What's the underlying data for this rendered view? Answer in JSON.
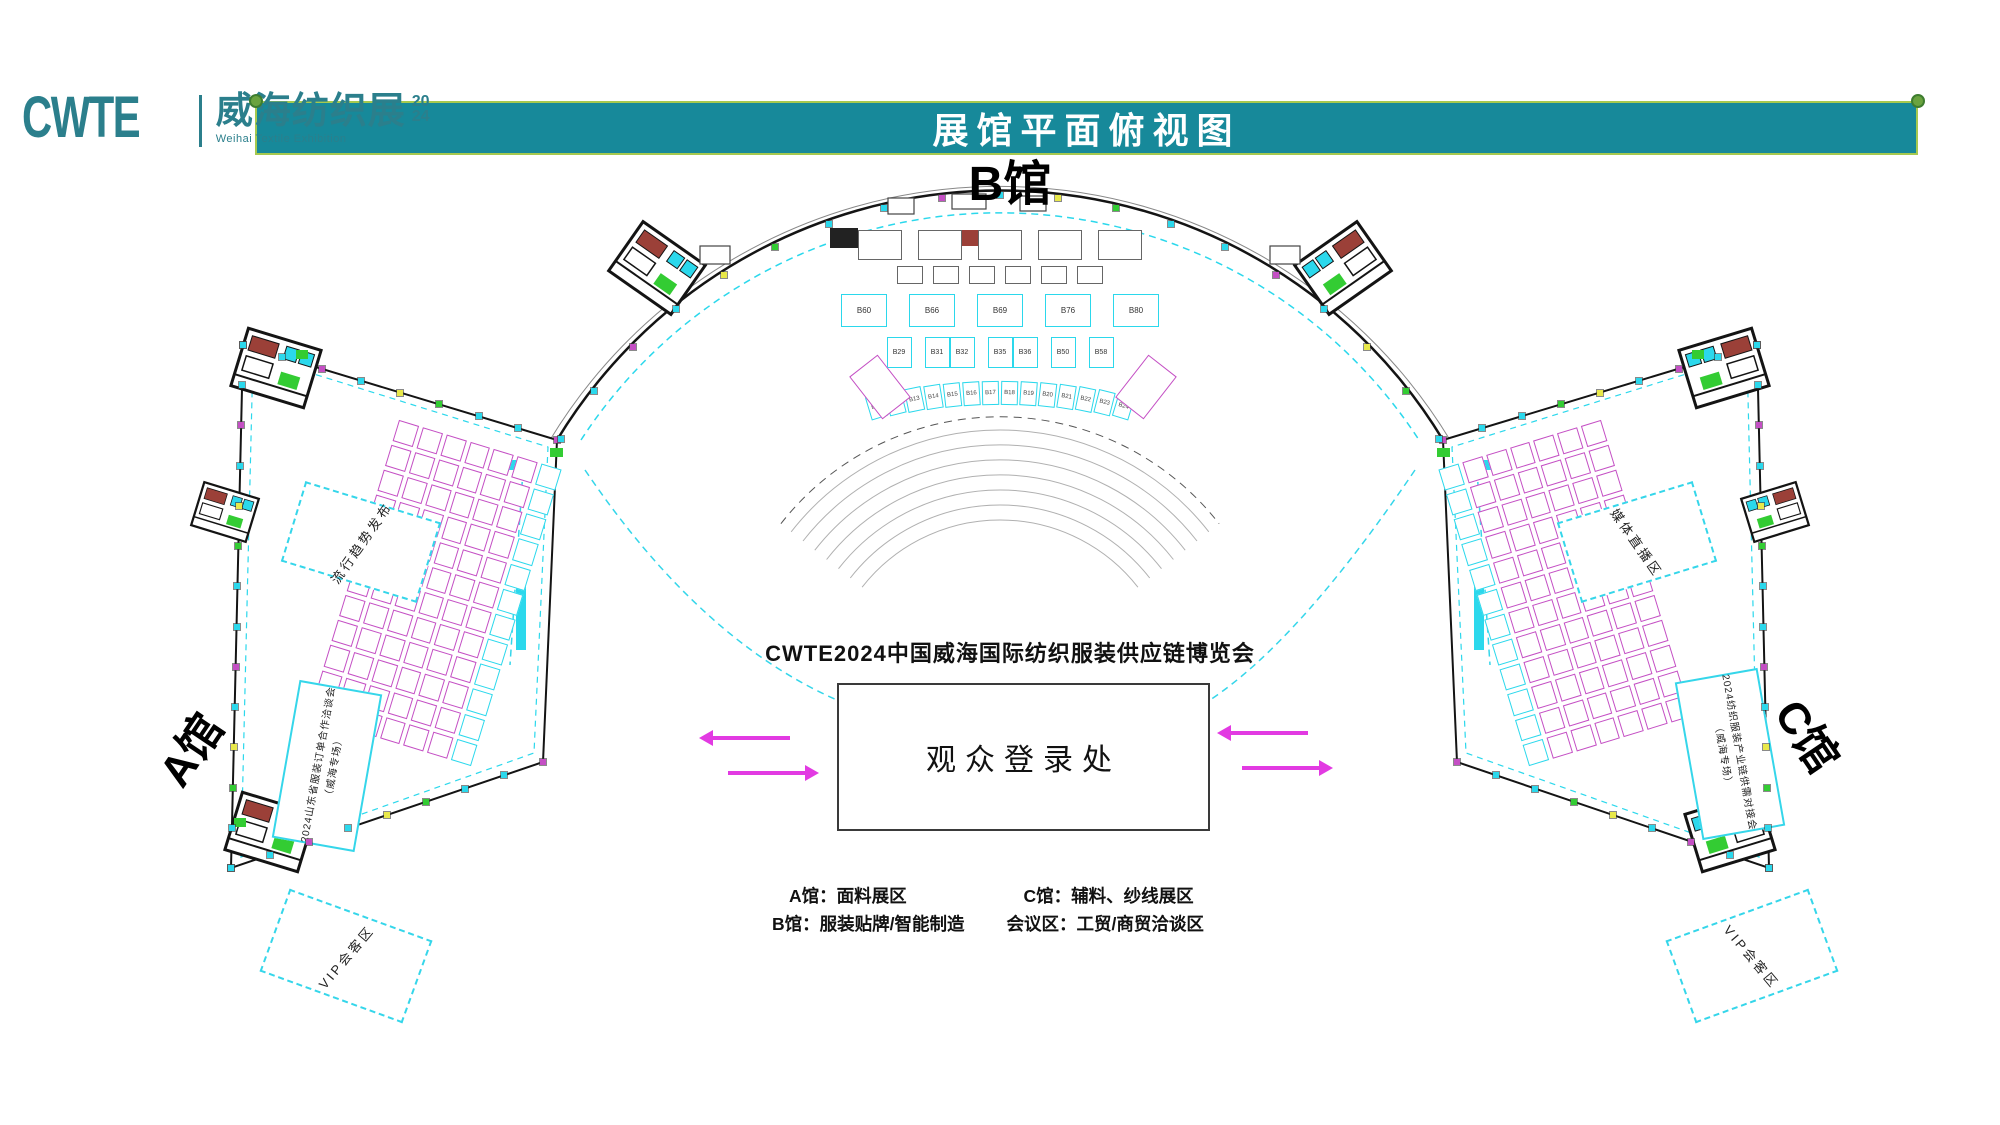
{
  "logo": {
    "acronym": "CWTE",
    "title_cn": "威海纺织展",
    "year_line1": "20",
    "year_line2": "24",
    "subtitle_en": "Weihai Textile Exhibition"
  },
  "banner": {
    "title": "展馆平面俯视图"
  },
  "hall_labels": {
    "a": "A馆",
    "b": "B馆",
    "c": "C馆"
  },
  "center_area": {
    "expo_title": "CWTE2024中国威海国际纺织服装供应链博览会",
    "registration_label": "观众登录处"
  },
  "legend": {
    "a": "A馆：面料展区",
    "b": "B馆：服装贴牌/智能制造",
    "c": "C馆：辅料、纱线展区",
    "meeting": "会议区：工贸/商贸洽谈区"
  },
  "zones": {
    "a_trend": "流行趋势发布",
    "a_meeting_main": "2024山东省服装订单合作洽谈会",
    "a_meeting_sub": "（威海专场）",
    "a_vip": "VIP会客区",
    "c_media": "媒体直播区",
    "c_meeting_main": "2024纺织服装产业链供需对接会",
    "c_meeting_sub": "（威海专场）",
    "c_vip": "VIP会客区"
  },
  "b_booths": {
    "row1": [
      "B60",
      "B66",
      "B69",
      "B76",
      "B80"
    ],
    "row2": [
      [
        "B29"
      ],
      [
        "B31",
        "B32"
      ],
      [
        "B35",
        "B36"
      ],
      [
        "B50"
      ],
      [
        "B58"
      ]
    ],
    "arc": [
      "B11",
      "B12",
      "B13",
      "B14",
      "B15",
      "B16",
      "B17",
      "B18",
      "B19",
      "B20",
      "B21",
      "B22",
      "B23",
      "B24"
    ]
  },
  "colors": {
    "teal_banner": "#17899A",
    "teal_logo": "#2B7F8C",
    "banner_border": "#A6C94F",
    "booth_magenta": "#C44FC4",
    "booth_cyan": "#2BD8EC",
    "arrow_magenta": "#E23AE2",
    "door_green": "#33CC33",
    "stair_red": "#9B4038",
    "wall_black": "#141414",
    "tick_yellow": "#E8E84A"
  }
}
